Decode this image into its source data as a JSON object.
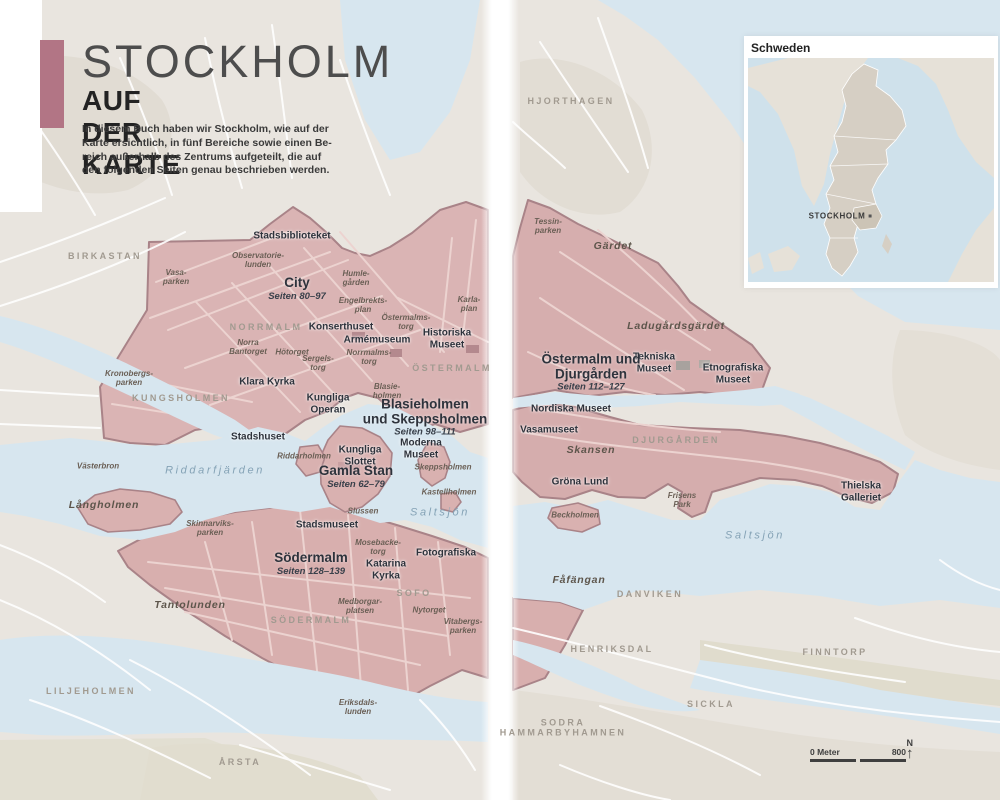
{
  "header": {
    "title": "STOCKHOLM",
    "subtitle": "AUF DER KARTE",
    "intro": "In diesem Buch haben wir Stockholm, wie auf der\nKarte ersichtlich, in fünf Bereiche sowie einen Be-\nreich außerhalb des Zentrums aufgeteilt, die auf\nden folgenden Seiten genau beschrieben werden.",
    "accent_color": "#b27585"
  },
  "inset": {
    "title": "Schweden",
    "city_label": "STOCKHOLM"
  },
  "scale_bar": {
    "left_label": "0 Meter",
    "right_label": "800",
    "north_label": "N"
  },
  "colors": {
    "highlight_fill": "#d9b1b0",
    "highlight_border": "#a98388",
    "water": "#d7e6ef",
    "land": "#e9e5df",
    "accent": "#b27585"
  },
  "area_labels": [
    {
      "name": "City",
      "seiten": "Seiten 80–97",
      "x": 297,
      "y": 289
    },
    {
      "name": "Gamla Stan",
      "seiten": "Seiten 62–79",
      "x": 356,
      "y": 477
    },
    {
      "name": "Blasieholmen\nund Skeppsholmen",
      "seiten": "Seiten 98–111",
      "x": 425,
      "y": 418
    },
    {
      "name": "Södermalm",
      "seiten": "Seiten 128–139",
      "x": 311,
      "y": 564
    },
    {
      "name": "Östermalm und\nDjurgården",
      "seiten": "Seiten 112–127",
      "x": 591,
      "y": 373
    }
  ],
  "map_labels": [
    {
      "text": "BIRKASTAN",
      "x": 105,
      "y": 256,
      "type": "district"
    },
    {
      "text": "Vasa-\nparken",
      "x": 176,
      "y": 277,
      "type": "park"
    },
    {
      "text": "Observatorie-\nlunden",
      "x": 258,
      "y": 260,
      "type": "park"
    },
    {
      "text": "Stadsbiblioteket",
      "x": 292,
      "y": 236,
      "type": "poi"
    },
    {
      "text": "Humle-\ngården",
      "x": 356,
      "y": 278,
      "type": "park"
    },
    {
      "text": "Engelbrekts-\nplan",
      "x": 363,
      "y": 305,
      "type": "park"
    },
    {
      "text": "NORRMALM",
      "x": 266,
      "y": 327,
      "type": "district"
    },
    {
      "text": "Konserthuset",
      "x": 341,
      "y": 327,
      "type": "poi"
    },
    {
      "text": "Armémuseum",
      "x": 377,
      "y": 340,
      "type": "poi"
    },
    {
      "text": "Norra\nBantorget",
      "x": 248,
      "y": 347,
      "type": "park"
    },
    {
      "text": "Hötorget",
      "x": 292,
      "y": 352,
      "type": "park"
    },
    {
      "text": "Norrmalms-\ntorg",
      "x": 369,
      "y": 357,
      "type": "park"
    },
    {
      "text": "Sergels-\ntorg",
      "x": 318,
      "y": 363,
      "type": "park"
    },
    {
      "text": "Östermalms-\ntorg",
      "x": 406,
      "y": 322,
      "type": "park"
    },
    {
      "text": "Karla-\nplan",
      "x": 469,
      "y": 304,
      "type": "park"
    },
    {
      "text": "Historiska\nMuseet",
      "x": 447,
      "y": 339,
      "type": "poi"
    },
    {
      "text": "ÖSTERMALM",
      "x": 452,
      "y": 368,
      "type": "district"
    },
    {
      "text": "Klara Kyrka",
      "x": 267,
      "y": 382,
      "type": "poi"
    },
    {
      "text": "Kungliga\nOperan",
      "x": 328,
      "y": 404,
      "type": "poi"
    },
    {
      "text": "Blasie-\nholmen",
      "x": 387,
      "y": 391,
      "type": "park"
    },
    {
      "text": "KUNGSHOLMEN",
      "x": 181,
      "y": 398,
      "type": "district"
    },
    {
      "text": "Kronobergs-\nparken",
      "x": 129,
      "y": 378,
      "type": "park"
    },
    {
      "text": "Stadshuset",
      "x": 258,
      "y": 437,
      "type": "poi"
    },
    {
      "text": "Moderna\nMuseet",
      "x": 421,
      "y": 449,
      "type": "poi"
    },
    {
      "text": "Riddarholmen",
      "x": 304,
      "y": 456,
      "type": "park"
    },
    {
      "text": "Kungliga\nSlottet",
      "x": 360,
      "y": 456,
      "type": "poi"
    },
    {
      "text": "Västerbron",
      "x": 98,
      "y": 466,
      "type": "park"
    },
    {
      "text": "Riddarfjärden",
      "x": 215,
      "y": 471,
      "type": "water-big"
    },
    {
      "text": "Långholmen",
      "x": 104,
      "y": 505,
      "type": "park-big"
    },
    {
      "text": "Skeppsholmen",
      "x": 443,
      "y": 467,
      "type": "park"
    },
    {
      "text": "Kastellholmen",
      "x": 449,
      "y": 492,
      "type": "park"
    },
    {
      "text": "Slussen",
      "x": 363,
      "y": 511,
      "type": "park"
    },
    {
      "text": "Saltsjön",
      "x": 440,
      "y": 513,
      "type": "water-big"
    },
    {
      "text": "Stadsmuseet",
      "x": 327,
      "y": 525,
      "type": "poi"
    },
    {
      "text": "Skinnarviks-\nparken",
      "x": 210,
      "y": 528,
      "type": "park"
    },
    {
      "text": "Mosebacke-\ntorg",
      "x": 378,
      "y": 547,
      "type": "park"
    },
    {
      "text": "Katarina\nKyrka",
      "x": 386,
      "y": 570,
      "type": "poi"
    },
    {
      "text": "Fotografiska",
      "x": 446,
      "y": 553,
      "type": "poi"
    },
    {
      "text": "SOFO",
      "x": 414,
      "y": 593,
      "type": "district"
    },
    {
      "text": "Medborgar-\nplatsen",
      "x": 360,
      "y": 606,
      "type": "park"
    },
    {
      "text": "Nytorget",
      "x": 429,
      "y": 610,
      "type": "park"
    },
    {
      "text": "Vitabergs-\nparken",
      "x": 463,
      "y": 626,
      "type": "park"
    },
    {
      "text": "SÖDERMALM",
      "x": 311,
      "y": 620,
      "type": "district"
    },
    {
      "text": "Tantolunden",
      "x": 190,
      "y": 605,
      "type": "park-big"
    },
    {
      "text": "Eriksdals-\nlunden",
      "x": 358,
      "y": 707,
      "type": "park"
    },
    {
      "text": "LILJEHOLMEN",
      "x": 91,
      "y": 691,
      "type": "district"
    },
    {
      "text": "ÅRSTA",
      "x": 240,
      "y": 762,
      "type": "district"
    },
    {
      "text": "HJORTHAGEN",
      "x": 571,
      "y": 101,
      "type": "district"
    },
    {
      "text": "Tessin-\nparken",
      "x": 548,
      "y": 226,
      "type": "park"
    },
    {
      "text": "Gärdet",
      "x": 613,
      "y": 246,
      "type": "park-big"
    },
    {
      "text": "Ladugårdsgärdet",
      "x": 676,
      "y": 326,
      "type": "park-big"
    },
    {
      "text": "Tekniska\nMuseet",
      "x": 654,
      "y": 363,
      "type": "poi"
    },
    {
      "text": "Etnografiska\nMuseet",
      "x": 733,
      "y": 374,
      "type": "poi"
    },
    {
      "text": "Nordiska Museet",
      "x": 571,
      "y": 409,
      "type": "poi"
    },
    {
      "text": "Vasamuseet",
      "x": 549,
      "y": 430,
      "type": "poi"
    },
    {
      "text": "Skansen",
      "x": 591,
      "y": 450,
      "type": "park-big"
    },
    {
      "text": "DJURGÅRDEN",
      "x": 676,
      "y": 440,
      "type": "district"
    },
    {
      "text": "Gröna Lund",
      "x": 580,
      "y": 482,
      "type": "poi"
    },
    {
      "text": "Frisens\nPark",
      "x": 682,
      "y": 500,
      "type": "park"
    },
    {
      "text": "Beckholmen",
      "x": 575,
      "y": 515,
      "type": "park"
    },
    {
      "text": "Saltsjön",
      "x": 755,
      "y": 536,
      "type": "water-big"
    },
    {
      "text": "Thielska\nGalleriet",
      "x": 861,
      "y": 492,
      "type": "poi"
    },
    {
      "text": "Fåfängan",
      "x": 579,
      "y": 580,
      "type": "park-big"
    },
    {
      "text": "DANVIKEN",
      "x": 650,
      "y": 594,
      "type": "district"
    },
    {
      "text": "HENRIKSDAL",
      "x": 612,
      "y": 649,
      "type": "district"
    },
    {
      "text": "FINNTORP",
      "x": 835,
      "y": 652,
      "type": "district"
    },
    {
      "text": "SICKLA",
      "x": 711,
      "y": 704,
      "type": "district"
    },
    {
      "text": "SODRA\nHAMMARBYHAMNEN",
      "x": 563,
      "y": 728,
      "type": "district"
    }
  ]
}
